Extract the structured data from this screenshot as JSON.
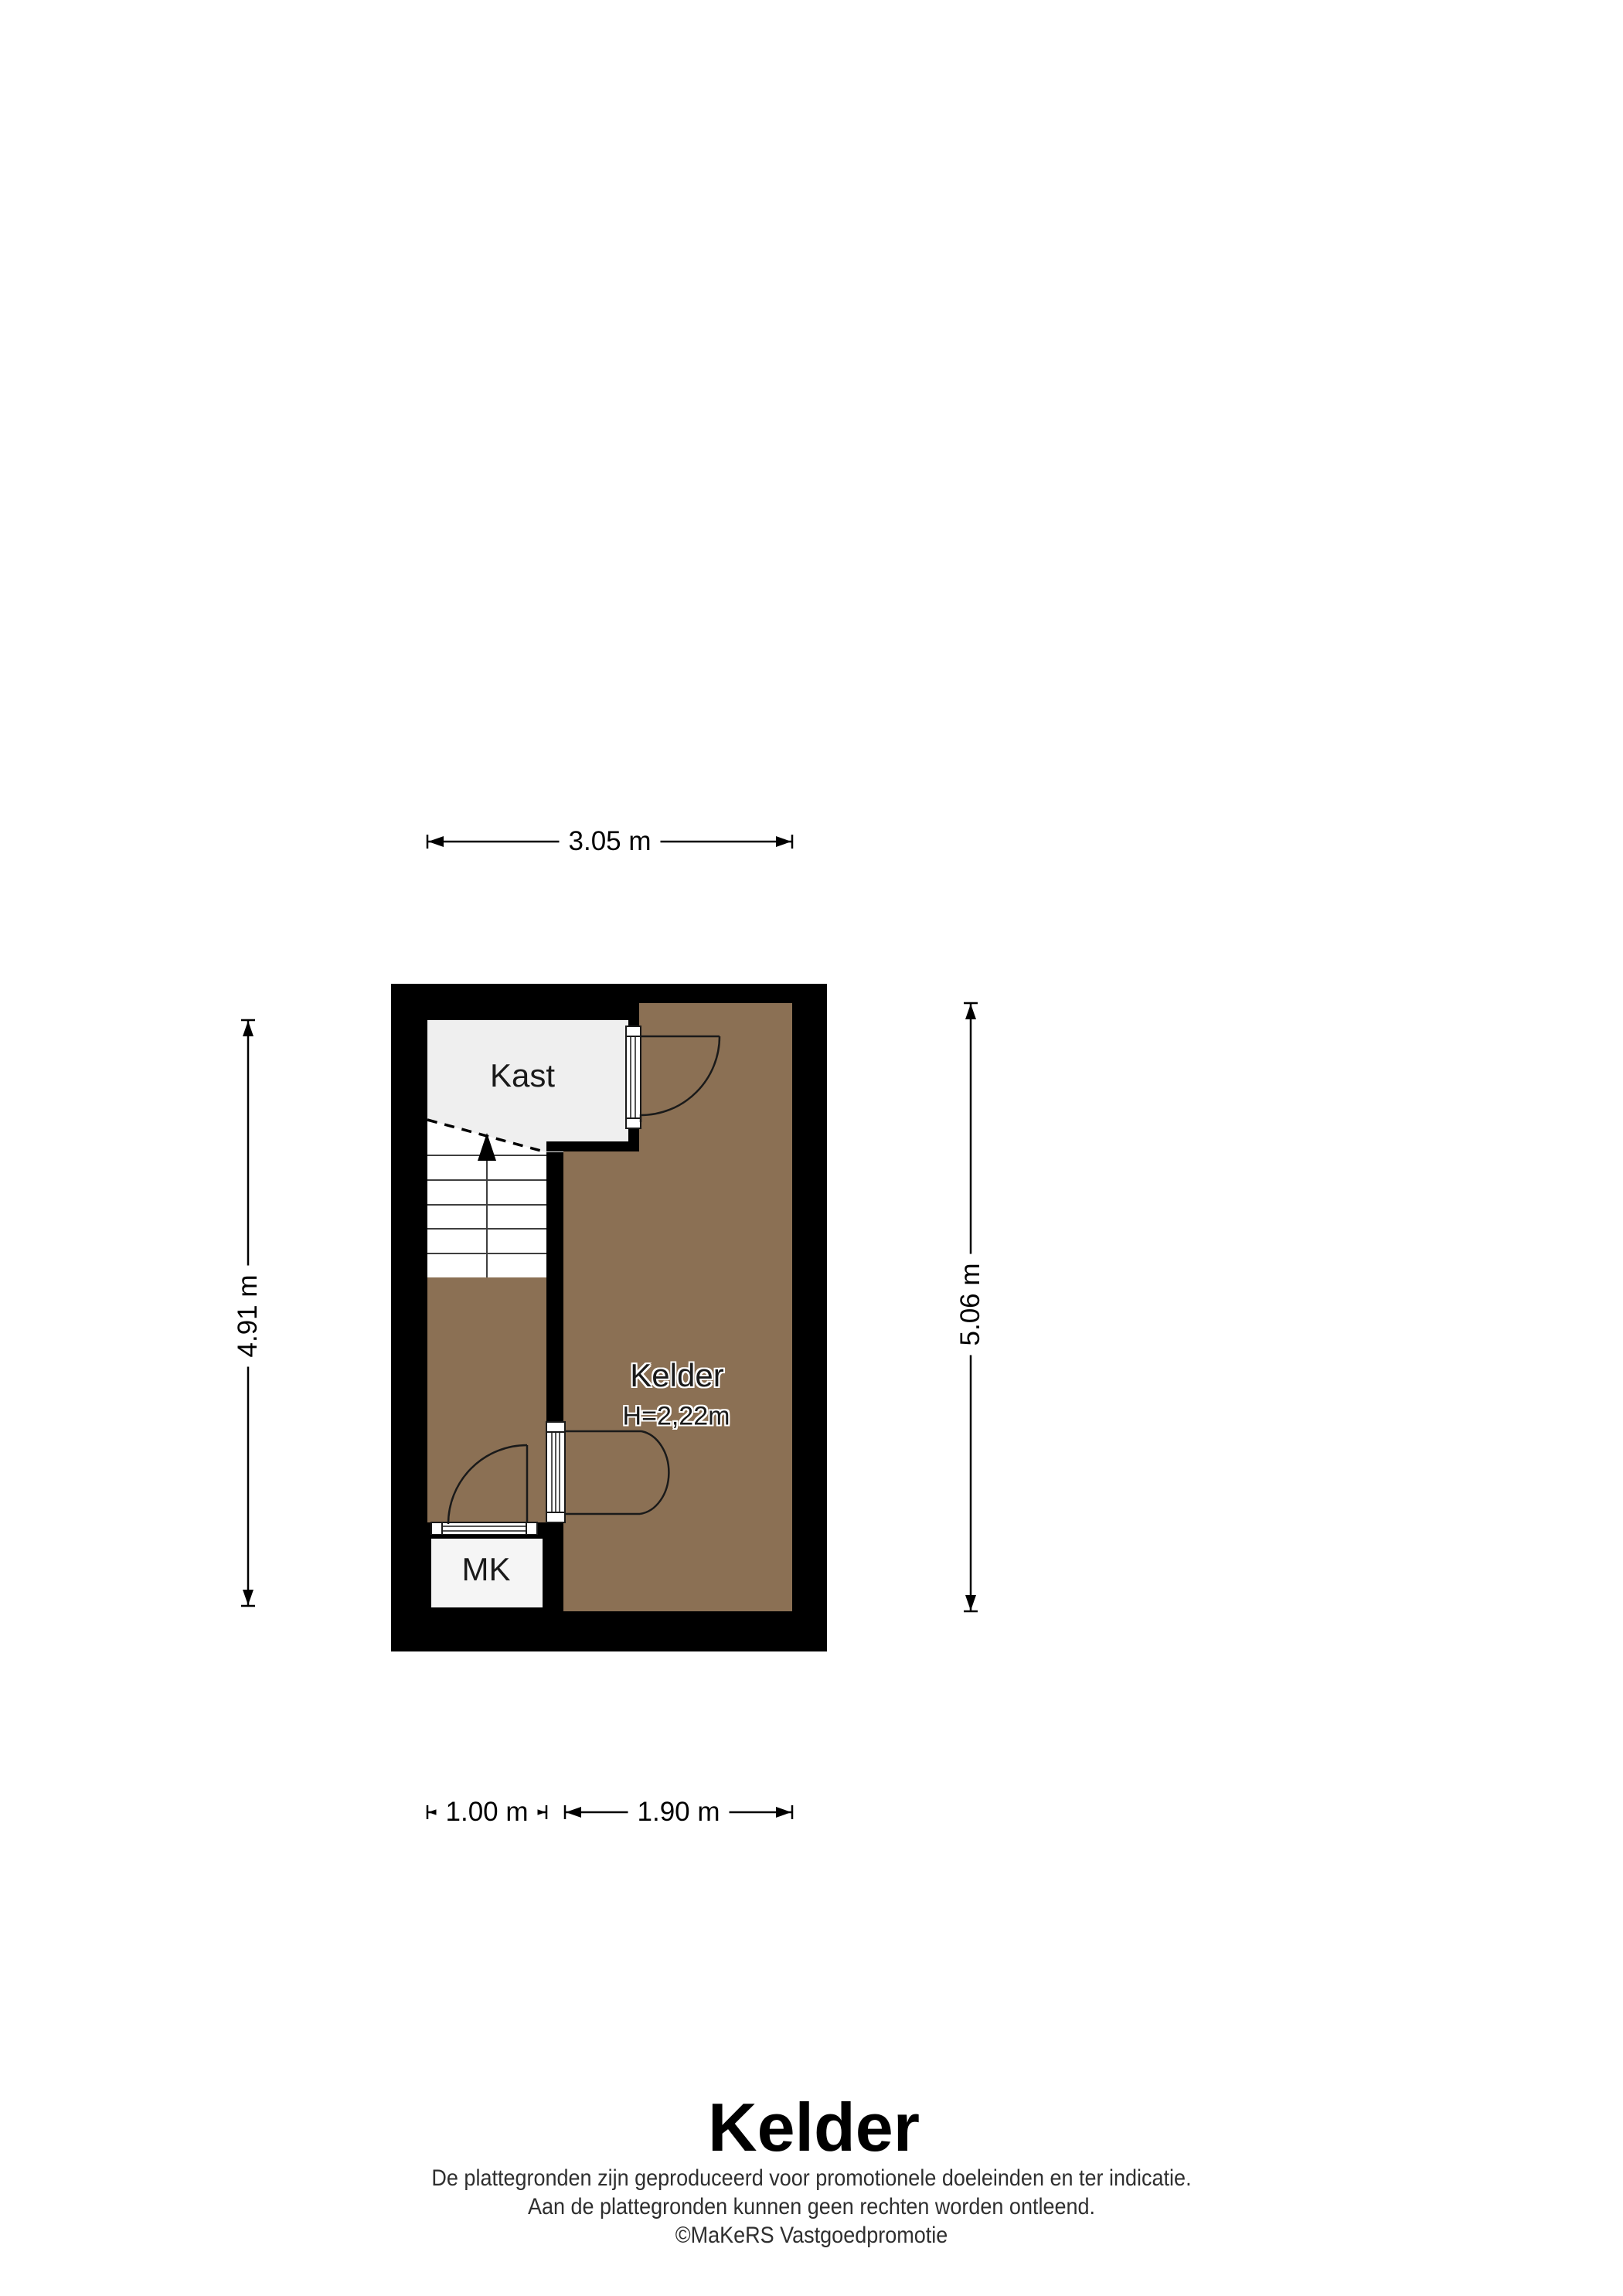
{
  "plan": {
    "rooms": {
      "kast": {
        "label": "Kast"
      },
      "kelder": {
        "label": "Kelder",
        "height_note": "H=2,22m"
      },
      "mk": {
        "label": "MK"
      }
    },
    "colors": {
      "wall": "#000000",
      "floor_brown": "#8b7054",
      "kast_gray": "#efefef",
      "stairs_white": "#ffffff",
      "mk_white": "#f5f5f5",
      "line_dark": "#1a1a1a"
    }
  },
  "dimensions": {
    "top": "3.05 m",
    "left": "4.91 m",
    "right": "5.06 m",
    "bottom_left": "1.00 m",
    "bottom_right": "1.90 m"
  },
  "footer": {
    "title": "Kelder",
    "disclaimer_line1": "De plattegronden zijn geproduceerd voor promotionele doeleinden en ter indicatie.",
    "disclaimer_line2": "Aan de plattegronden kunnen geen rechten worden ontleend.",
    "credit": "©MaKeRS Vastgoedpromotie"
  }
}
